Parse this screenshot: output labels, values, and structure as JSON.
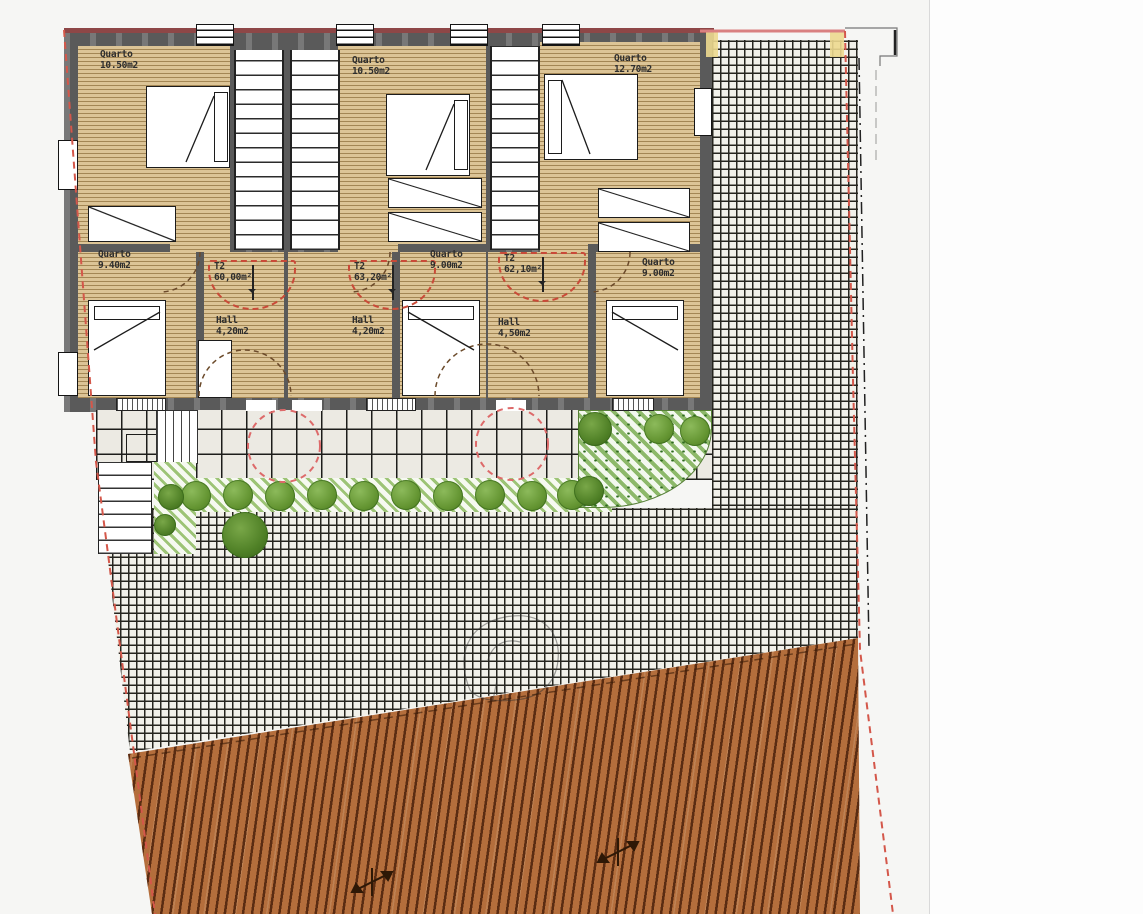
{
  "units": [
    {
      "id": "unit-1",
      "type_label": "T2",
      "area_label": "60,00m²",
      "hall": {
        "name": "Hall",
        "area": "4,20m2"
      },
      "rooms": [
        {
          "name": "Quarto",
          "area": "10.50m2"
        },
        {
          "name": "Quarto",
          "area": "9.40m2"
        }
      ]
    },
    {
      "id": "unit-2",
      "type_label": "T2",
      "area_label": "63,20m²",
      "hall": {
        "name": "Hall",
        "area": "4,20m2"
      },
      "rooms": [
        {
          "name": "Quarto",
          "area": "10.50m2"
        },
        {
          "name": "Quarto",
          "area": "9.00m2"
        }
      ]
    },
    {
      "id": "unit-3",
      "type_label": "T2",
      "area_label": "62,10m²",
      "hall": {
        "name": "Hall",
        "area": "4,50m2"
      },
      "rooms": [
        {
          "name": "Quarto",
          "area": "12.70m2"
        },
        {
          "name": "Quarto",
          "area": "9.00m2"
        }
      ]
    }
  ],
  "colors": {
    "wall_gray": "#5a5a5a",
    "wood_floor": "#dcc496",
    "facade_maroon": "#8e4747",
    "boundary_red": "#d4574a",
    "tree_circle_red": "#dd6a6a",
    "paving_bg": "#f2f1ea",
    "grid_line": "#26251f",
    "roof_tile": "#b46e3c",
    "roof_line": "#5a2c12",
    "shrub_green": "#639431",
    "hatch_green": "#9dc476",
    "marker_yellow": "#edd98f"
  }
}
